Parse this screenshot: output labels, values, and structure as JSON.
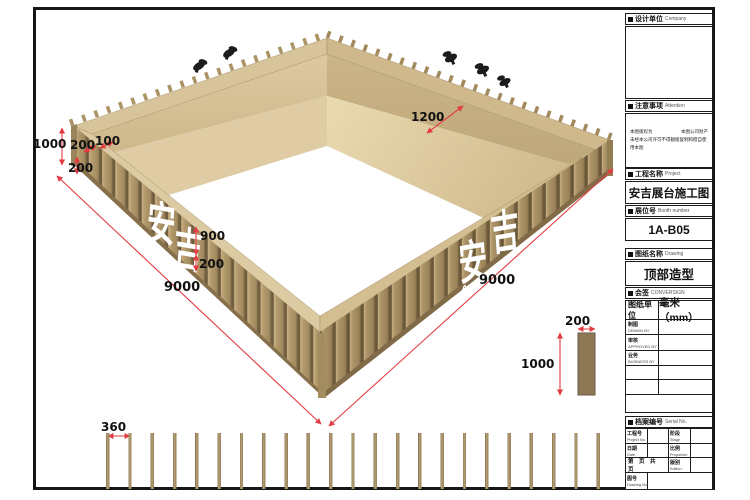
{
  "drawing": {
    "logo": {
      "char1": "安",
      "char2": "吉",
      "latin": "AN JI"
    },
    "dimensions": {
      "wall_height": "1000",
      "rim_200": "200",
      "rim_100": "100",
      "corner_200": "200",
      "panel_900": "900",
      "panel_200": "200",
      "side_left": "9000",
      "side_right": "9000",
      "shelf_width": "1200"
    },
    "slat_detail": {
      "spacing": "360"
    },
    "panel_detail": {
      "width": "200",
      "height": "1000"
    },
    "colors": {
      "wood": "#b49c6e",
      "dimension_red": "#e23b41",
      "line_black": "#161616"
    }
  },
  "titleblock": {
    "company": {
      "zh": "设计单位",
      "en": "Company"
    },
    "attention": {
      "zh": "注意事项",
      "en": "Attention",
      "note1_left": "本图版权为",
      "note1_right": "本图公司财产",
      "note2": "未经本公司许可不得翻版复制和擅自使用本图"
    },
    "project": {
      "zh": "工程名称",
      "en": "Project",
      "value": "安吉展台施工图"
    },
    "booth": {
      "zh": "展位号",
      "en": "Booth number",
      "value": "1A-B05"
    },
    "drawing_name": {
      "zh": "图纸名称",
      "en": "Drawing",
      "value": "顶部造型"
    },
    "conversign": {
      "zh": "会签",
      "en": "CONVERSIGN"
    },
    "units": {
      "label": "图纸单位",
      "value": "毫米（mm）"
    },
    "sign_rows": [
      {
        "zh": "制图",
        "en": "DRAWN BY"
      },
      {
        "zh": "审核",
        "en": "APPROVED BY"
      },
      {
        "zh": "业务",
        "en": "BUSINESS BY"
      }
    ],
    "serial": {
      "zh": "档案编号",
      "en": "Serial No."
    },
    "grid": {
      "project_no": {
        "zh": "工程号",
        "en": "Project No."
      },
      "stage": {
        "zh": "阶段",
        "en": "Stage"
      },
      "date": {
        "zh": "日期",
        "en": "Date"
      },
      "proportion": {
        "zh": "比例",
        "en": "Proportion"
      },
      "pages": "第 页 共 页",
      "edition": {
        "zh": "版别",
        "en": "Edition"
      },
      "drawing_no": {
        "zh": "图号",
        "en": "Drawing No."
      }
    }
  }
}
